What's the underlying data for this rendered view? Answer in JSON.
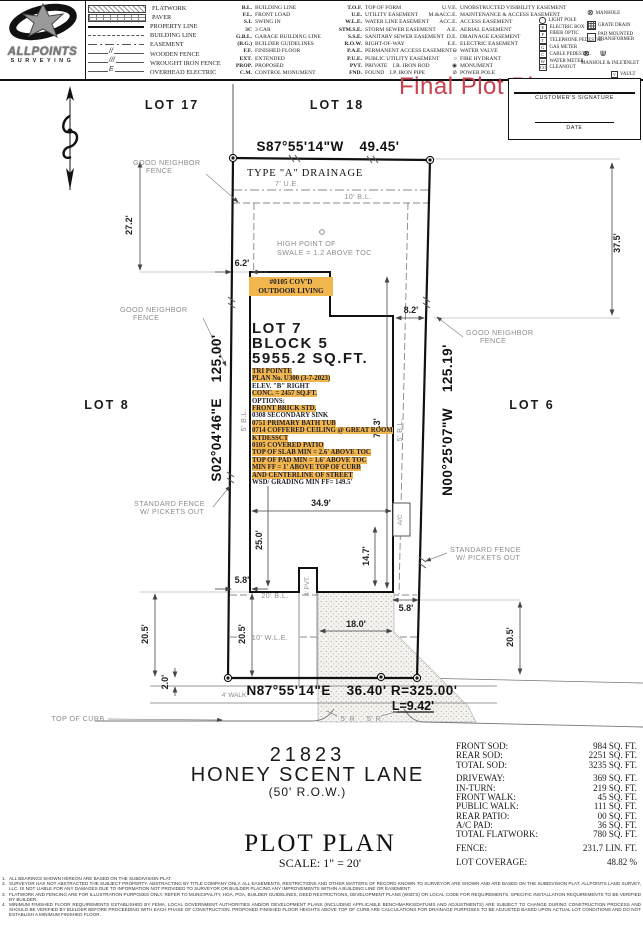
{
  "colors": {
    "highlight": "#f2b64e",
    "red": "#c8414d"
  },
  "header": {
    "logo": {
      "line1": "ALLPOINTS",
      "line2": "SURVEYING"
    },
    "legend": {
      "linetypes": [
        {
          "swatch": "flatwork",
          "label": "FLATWORK"
        },
        {
          "swatch": "paver",
          "label": "PAVER"
        },
        {
          "swatch": "property-line",
          "label": "PROPERTY LINE"
        },
        {
          "swatch": "building-line",
          "label": "BUILDING LINE"
        },
        {
          "swatch": "easement",
          "label": "EASEMENT"
        },
        {
          "swatch": "wooden-fence",
          "mark": "//",
          "label": "WOODEN FENCE"
        },
        {
          "swatch": "wrought-iron-fence",
          "mark": "///",
          "label": "WROUGHT IRON FENCE"
        },
        {
          "swatch": "overhead-electric",
          "mark": "E",
          "label": "OVERHEAD ELECTRIC"
        }
      ],
      "abbrev_col1": [
        {
          "abbr": "B.L.",
          "label": "BUILDING LINE"
        },
        {
          "abbr": "F.L.",
          "label": "FRONT LOAD"
        },
        {
          "abbr": "S.I.",
          "label": "SWING IN"
        },
        {
          "abbr": "3C",
          "label": "3 CAR"
        },
        {
          "abbr": "G.B.L.",
          "label": "GARAGE BUILDING LINE"
        },
        {
          "abbr": "(B.G.)",
          "label": "BUILDER GUIDELINES"
        },
        {
          "abbr": "F.F.",
          "label": "FINISHED FLOOR"
        },
        {
          "abbr": "EXT.",
          "label": "EXTENDED"
        },
        {
          "abbr": "PROP.",
          "label": "PROPOSED"
        },
        {
          "abbr": "C.M.",
          "label": "CONTROL MONUMENT"
        }
      ],
      "abbrev_col2": [
        {
          "abbr": "T.O.F.",
          "label": "TOP OF FORM"
        },
        {
          "abbr": "U.E.",
          "label": "UTILITY EASEMENT"
        },
        {
          "abbr": "W.L.E.",
          "label": "WATER LINE EASEMENT"
        },
        {
          "abbr": "STM.S.E.",
          "label": "STORM SEWER EASEMENT"
        },
        {
          "abbr": "S.S.E.",
          "label": "SANITARY SEWER EASEMENT"
        },
        {
          "abbr": "R.O.W.",
          "label": "RIGHT-OF-WAY"
        },
        {
          "abbr": "P.A.E.",
          "label": "PERMANENT ACCESS EASEMENT"
        },
        {
          "abbr": "P.U.E.",
          "label": "PUBLIC UTILITY EASEMENT"
        },
        {
          "abbr": "PVT.",
          "label": "PRIVATE   I.R. IRON ROD"
        },
        {
          "abbr": "FND.",
          "label": "FOUND   I.P. IRON PIPE"
        }
      ],
      "abbrev_col3": [
        {
          "abbr": "U.V.E.",
          "label": "UNOBSTRUCTED VISIBILITY EASEMENT"
        },
        {
          "abbr": "M.&ACC.E.",
          "label": "MAINTENANCE & ACCESS EASEMENT"
        },
        {
          "abbr": "ACC.E.",
          "label": "ACCESS EASEMENT"
        },
        {
          "abbr": "A.E.",
          "label": "AERIAL EASEMENT"
        },
        {
          "abbr": "D.E.",
          "label": "DRAINAGE EASEMENT"
        },
        {
          "abbr": "E.E.",
          "label": "ELECTRIC EASEMENT"
        },
        {
          "abbr": "⊖",
          "label": "WATER VALVE"
        },
        {
          "abbr": "○",
          "label": "FIRE HYDRANT"
        },
        {
          "abbr": "◉",
          "label": "MONUMENT"
        },
        {
          "abbr": "⊘",
          "label": "POWER POLE"
        }
      ],
      "symbols_col": [
        {
          "sym": "circle",
          "letter": "",
          "label": "LIGHT POLE"
        },
        {
          "sym": "box",
          "letter": "E",
          "label": "ELECTRIC BOX"
        },
        {
          "sym": "box",
          "letter": "F",
          "label": "FIBER OPTIC"
        },
        {
          "sym": "box",
          "letter": "T",
          "label": "TELEPHONE PEDESTAL"
        },
        {
          "sym": "box",
          "letter": "G",
          "label": "GAS METER"
        },
        {
          "sym": "box",
          "letter": "C",
          "label": "CABLE PEDESTAL"
        },
        {
          "sym": "box",
          "letter": "W",
          "label": "WATER METER"
        },
        {
          "sym": "box",
          "letter": "CO",
          "label": "CLEANOUT"
        }
      ],
      "misc": {
        "manhole": "MANHOLE",
        "grate_drain": "GRATE DRAIN",
        "transformer1": "PAD MOUNTED",
        "transformer2": "TRANSFORMER",
        "manhole_inlet": "MANHOLE & INLET",
        "inlet": "INLET",
        "vault": "VAULT",
        "vault_letter": "V"
      }
    }
  },
  "title": {
    "final_plot_plan": "Final Plot Plan"
  },
  "signature": {
    "customer": "CUSTOMER'S  SIGNATURE",
    "date": "DATE"
  },
  "plan": {
    "lot17": "LOT 17",
    "lot18": "LOT 18",
    "lot8": "LOT 8",
    "lot6": "LOT 6",
    "bearing_rear": "S87°55'14\"W   49.45'",
    "type_a": "TYPE \"A\" DRAINAGE",
    "ue7": "7' U.E.",
    "bl10": "10' B.L.",
    "bl5": "5' B.L.",
    "bl20": "20' B.L.",
    "wle": "10' W.L.E.",
    "hp1": "HIGH POINT OF",
    "hp2": "SWALE = 1.2 ABOVE TOC",
    "d27": "27.2'",
    "d62": "6.2'",
    "d375": "37.5'",
    "d82": "8.2'",
    "gn1": "GOOD NEIGHBOR",
    "gn2": "FENCE",
    "sf1": "STANDARD FENCE",
    "sf2": "W/ PICKETS OUT",
    "bearing_left": "S02°04'46\"E   125.00'",
    "bearing_right": "N00°25'07\"W   125.19'",
    "d773": "77.3'",
    "d349": "34.9'",
    "d250": "25.0'",
    "d147": "14.7'",
    "ac": "A/C",
    "pvt": "4' PVT.",
    "d58": "5.8'",
    "d205": "20.5'",
    "d20": "2.0'",
    "d180": "18.0'",
    "walk4": "4' WALK",
    "bearing_front": "N87°55'14\"E   36.40' R=325.00'",
    "arc_len": "L=9.42'",
    "toc": "TOP OF CURB",
    "r5": "5' R"
  },
  "outdoor_living": {
    "line1": "#0105 COV'D",
    "line2": "OUTDOOR LIVING"
  },
  "options_block": {
    "lot": "LOT 7",
    "block": "BLOCK 5",
    "area": "5955.2 SQ.FT.",
    "lines": [
      {
        "text": "TRI POINTE",
        "hl": true
      },
      {
        "text": "PLAN No. U300 (3-7-2023)",
        "hl": true
      },
      {
        "text": "ELEV. \"B\" RIGHT",
        "hl": false
      },
      {
        "text": "CONC. = 2457 SQ.FT.",
        "hl": true
      },
      {
        "text": "OPTIONS:",
        "hl": false
      },
      {
        "text": "FRONT BRICK STD.",
        "hl": true
      },
      {
        "text": "0308 SECONDARY SINK",
        "hl": false
      },
      {
        "text": "0751 PRIMARY BATH TUB",
        "hl": true
      },
      {
        "text": "0714 COFFERED CEILING @ GREAT ROOM",
        "hl": true
      },
      {
        "text": "KTDESSCT",
        "hl": true
      },
      {
        "text": "0105 COVERED PATIO",
        "hl": true
      },
      {
        "text": "TOP OF SLAB MIN = 2.6' ABOVE TOC",
        "hl": true
      },
      {
        "text": "TOP OF PAD MIN =  1.6' ABOVE TOC",
        "hl": true
      },
      {
        "text": "MIN FF = 1' ABOVE TOP OF CURB",
        "hl": true
      },
      {
        "text": "AND CENTERLINE OF STREET",
        "hl": true
      },
      {
        "text": "WSD/ GRADING MIN FF= 149.5'",
        "hl": false
      }
    ]
  },
  "street": {
    "number": "21823",
    "name": "HONEY SCENT LANE",
    "row": "(50' R.O.W.)"
  },
  "plot_title": {
    "title": "PLOT PLAN",
    "scale": "SCALE: 1\" = 20'"
  },
  "sod_table": {
    "rows": [
      {
        "label": "FRONT SOD:",
        "value": "984 SQ. FT."
      },
      {
        "label": "REAR SOD:",
        "value": "2251 SQ. FT."
      },
      {
        "label": "TOTAL SOD:",
        "value": "3235 SQ. FT."
      },
      {
        "label": "DRIVEWAY:",
        "value": "369 SQ. FT.",
        "gap": true
      },
      {
        "label": "IN-TURN:",
        "value": "219 SQ. FT."
      },
      {
        "label": "FRONT WALK:",
        "value": "45 SQ. FT."
      },
      {
        "label": "PUBLIC WALK:",
        "value": "111 SQ. FT."
      },
      {
        "label": "REAR PATIO:",
        "value": "00 SQ. FT."
      },
      {
        "label": "A/C PAD:",
        "value": "36 SQ. FT."
      },
      {
        "label": "TOTAL FLATWORK:",
        "value": "780 SQ. FT."
      },
      {
        "label": "FENCE:",
        "value": "231.7 LIN. FT.",
        "gap": true
      },
      {
        "label": "LOT COVERAGE:",
        "value": "48.82 %",
        "gap": true
      }
    ]
  },
  "notes": [
    {
      "num": "1.",
      "text": "ALL BEARINGS SHOWN HEREON ARE BASED ON THE SUBDIVISION PLAT."
    },
    {
      "num": "2.",
      "text": "SURVEYOR HAS NOT ABSTRACTED THE SUBJECT PROPERTY. ABSTRACTING BY TITLE COMPANY ONLY. ALL EASEMENTS, RESTRICTIONS AND OTHER MATTERS OF RECORD KNOWN TO SURVEYOR ARE SHOWN AND ARE BASED ON THE SUBDIVISION PLAT. ALLPOINTS LAND SURVEY, LLC. IS NOT LIABLE FOR ANY DAMAGES DUE TO INFORMATION NOT PROVIDED TO SURVEYOR OR BUILDER PLACING ANY IMPROVEMENTS WITHIN A BUILDING LINE OR EASEMENT."
    },
    {
      "num": "3.",
      "text": "FLATWORK AND FENCING ARE FOR ILLUSTRATION PURPOSES ONLY. REFER TO MUNICIPALITY, HOA, POA, BUILDER GUIDELINES, DEED RESTRICTIONS, DEVELOPMENT PLANS (WSD'S) OR LOCAL CODE FOR REQUIREMENTS. SPECIFIC INSTALLATION REQUIREMENTS TO BE VERIFIED BY BUILDER."
    },
    {
      "num": "4.",
      "text": "MINIMUM FINISHED FLOOR REQUIREMENTS ESTABLISHED BY FEMA, LOCAL GOVERNMENT AUTHORITIES AND/OR DEVELOPMENT PLANS (INCLUDING APPLICABLE BENCHMARKS/DATUMS AND ADJUSTMENTS) ARE SUBJECT TO CHANGE DURING CONSTRUCTION PROCESS AND SHOULD BE VERIFIED BY BUILDER BEFORE PROCEEDING WITH EACH PHASE OF CONSTRUCTION. PROPOSED FINISHED FLOOR HEIGHTS ABOVE TOP OF CURB ARE CALCULATIONS FOR DRAINAGE PURPOSES TO BE ADJUSTED BASED UPON ACTUAL LOT CONDITIONS AND DO NOT ESTABLISH A MINIMUM FINISHED FLOOR."
    }
  ]
}
